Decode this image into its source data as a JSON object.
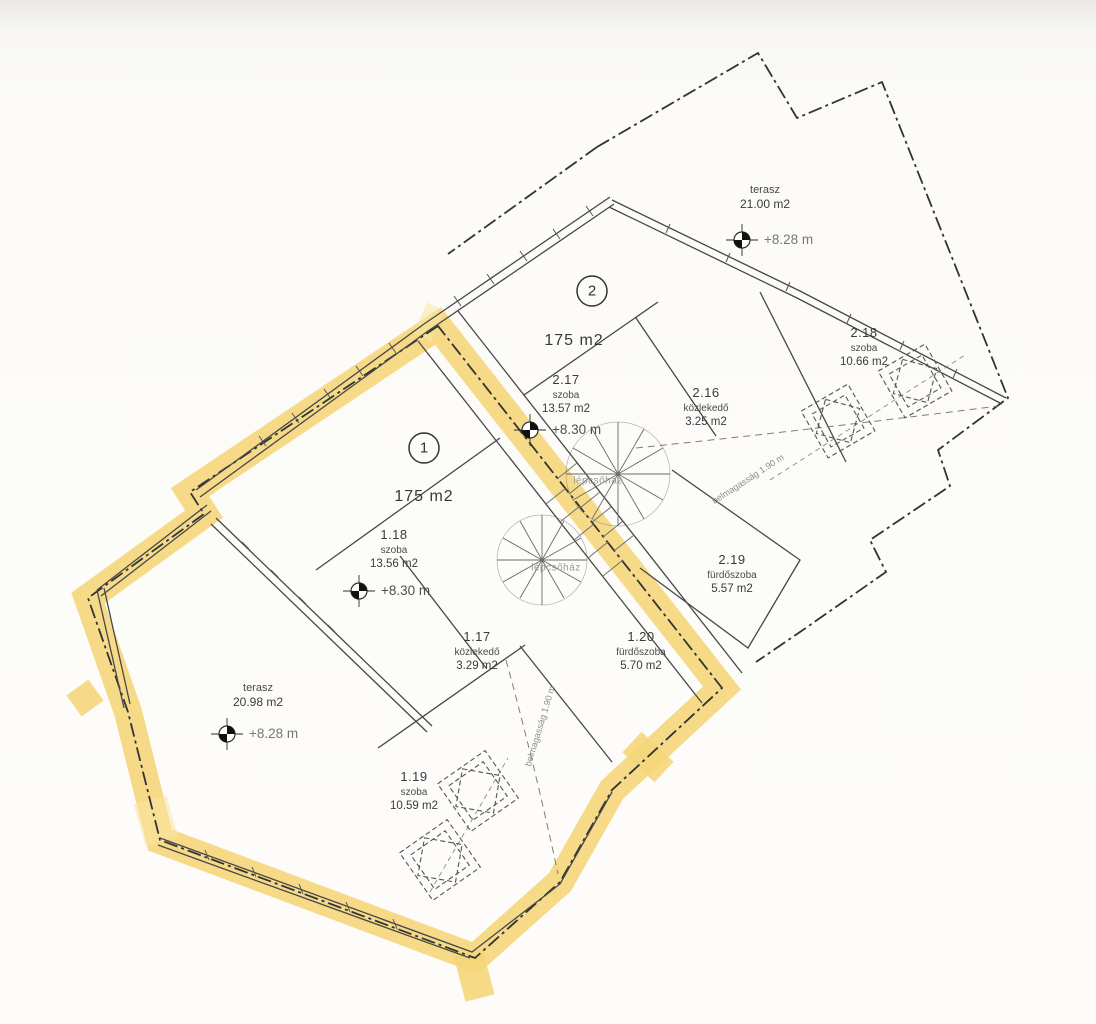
{
  "plan": {
    "units": [
      {
        "number": "1",
        "area_label": "175 m2",
        "terrace": {
          "name": "terasz",
          "area": "20.98 m2",
          "elevation": "+8.28 m"
        },
        "rooms": [
          {
            "id": "1.17",
            "name": "közlekedő",
            "area": "3.29 m2"
          },
          {
            "id": "1.18",
            "name": "szoba",
            "area": "13.56 m2",
            "elevation": "+8.30 m"
          },
          {
            "id": "1.19",
            "name": "szoba",
            "area": "10.59 m2"
          },
          {
            "id": "1.20",
            "name": "fürdőszoba",
            "area": "5.70 m2"
          }
        ],
        "stairwell_label": "lépcsőház",
        "headroom_note": "belmagasság 1.90 m"
      },
      {
        "number": "2",
        "area_label": "175 m2",
        "terrace": {
          "name": "terasz",
          "area": "21.00 m2",
          "elevation": "+8.28 m"
        },
        "rooms": [
          {
            "id": "2.16",
            "name": "közlekedő",
            "area": "3.25 m2"
          },
          {
            "id": "2.17",
            "name": "szoba",
            "area": "13.57 m2",
            "elevation": "+8.30 m"
          },
          {
            "id": "2.18",
            "name": "szoba",
            "area": "10.66 m2"
          },
          {
            "id": "2.19",
            "name": "fürdőszoba",
            "area": "5.57 m2"
          }
        ],
        "stairwell_label": "lépcsőház",
        "headroom_note": "belmagasság 1.90 m"
      }
    ],
    "colors": {
      "highlight": "#f5d67a",
      "line": "#3c3c3c",
      "muted_text": "#8d8d8d"
    }
  }
}
